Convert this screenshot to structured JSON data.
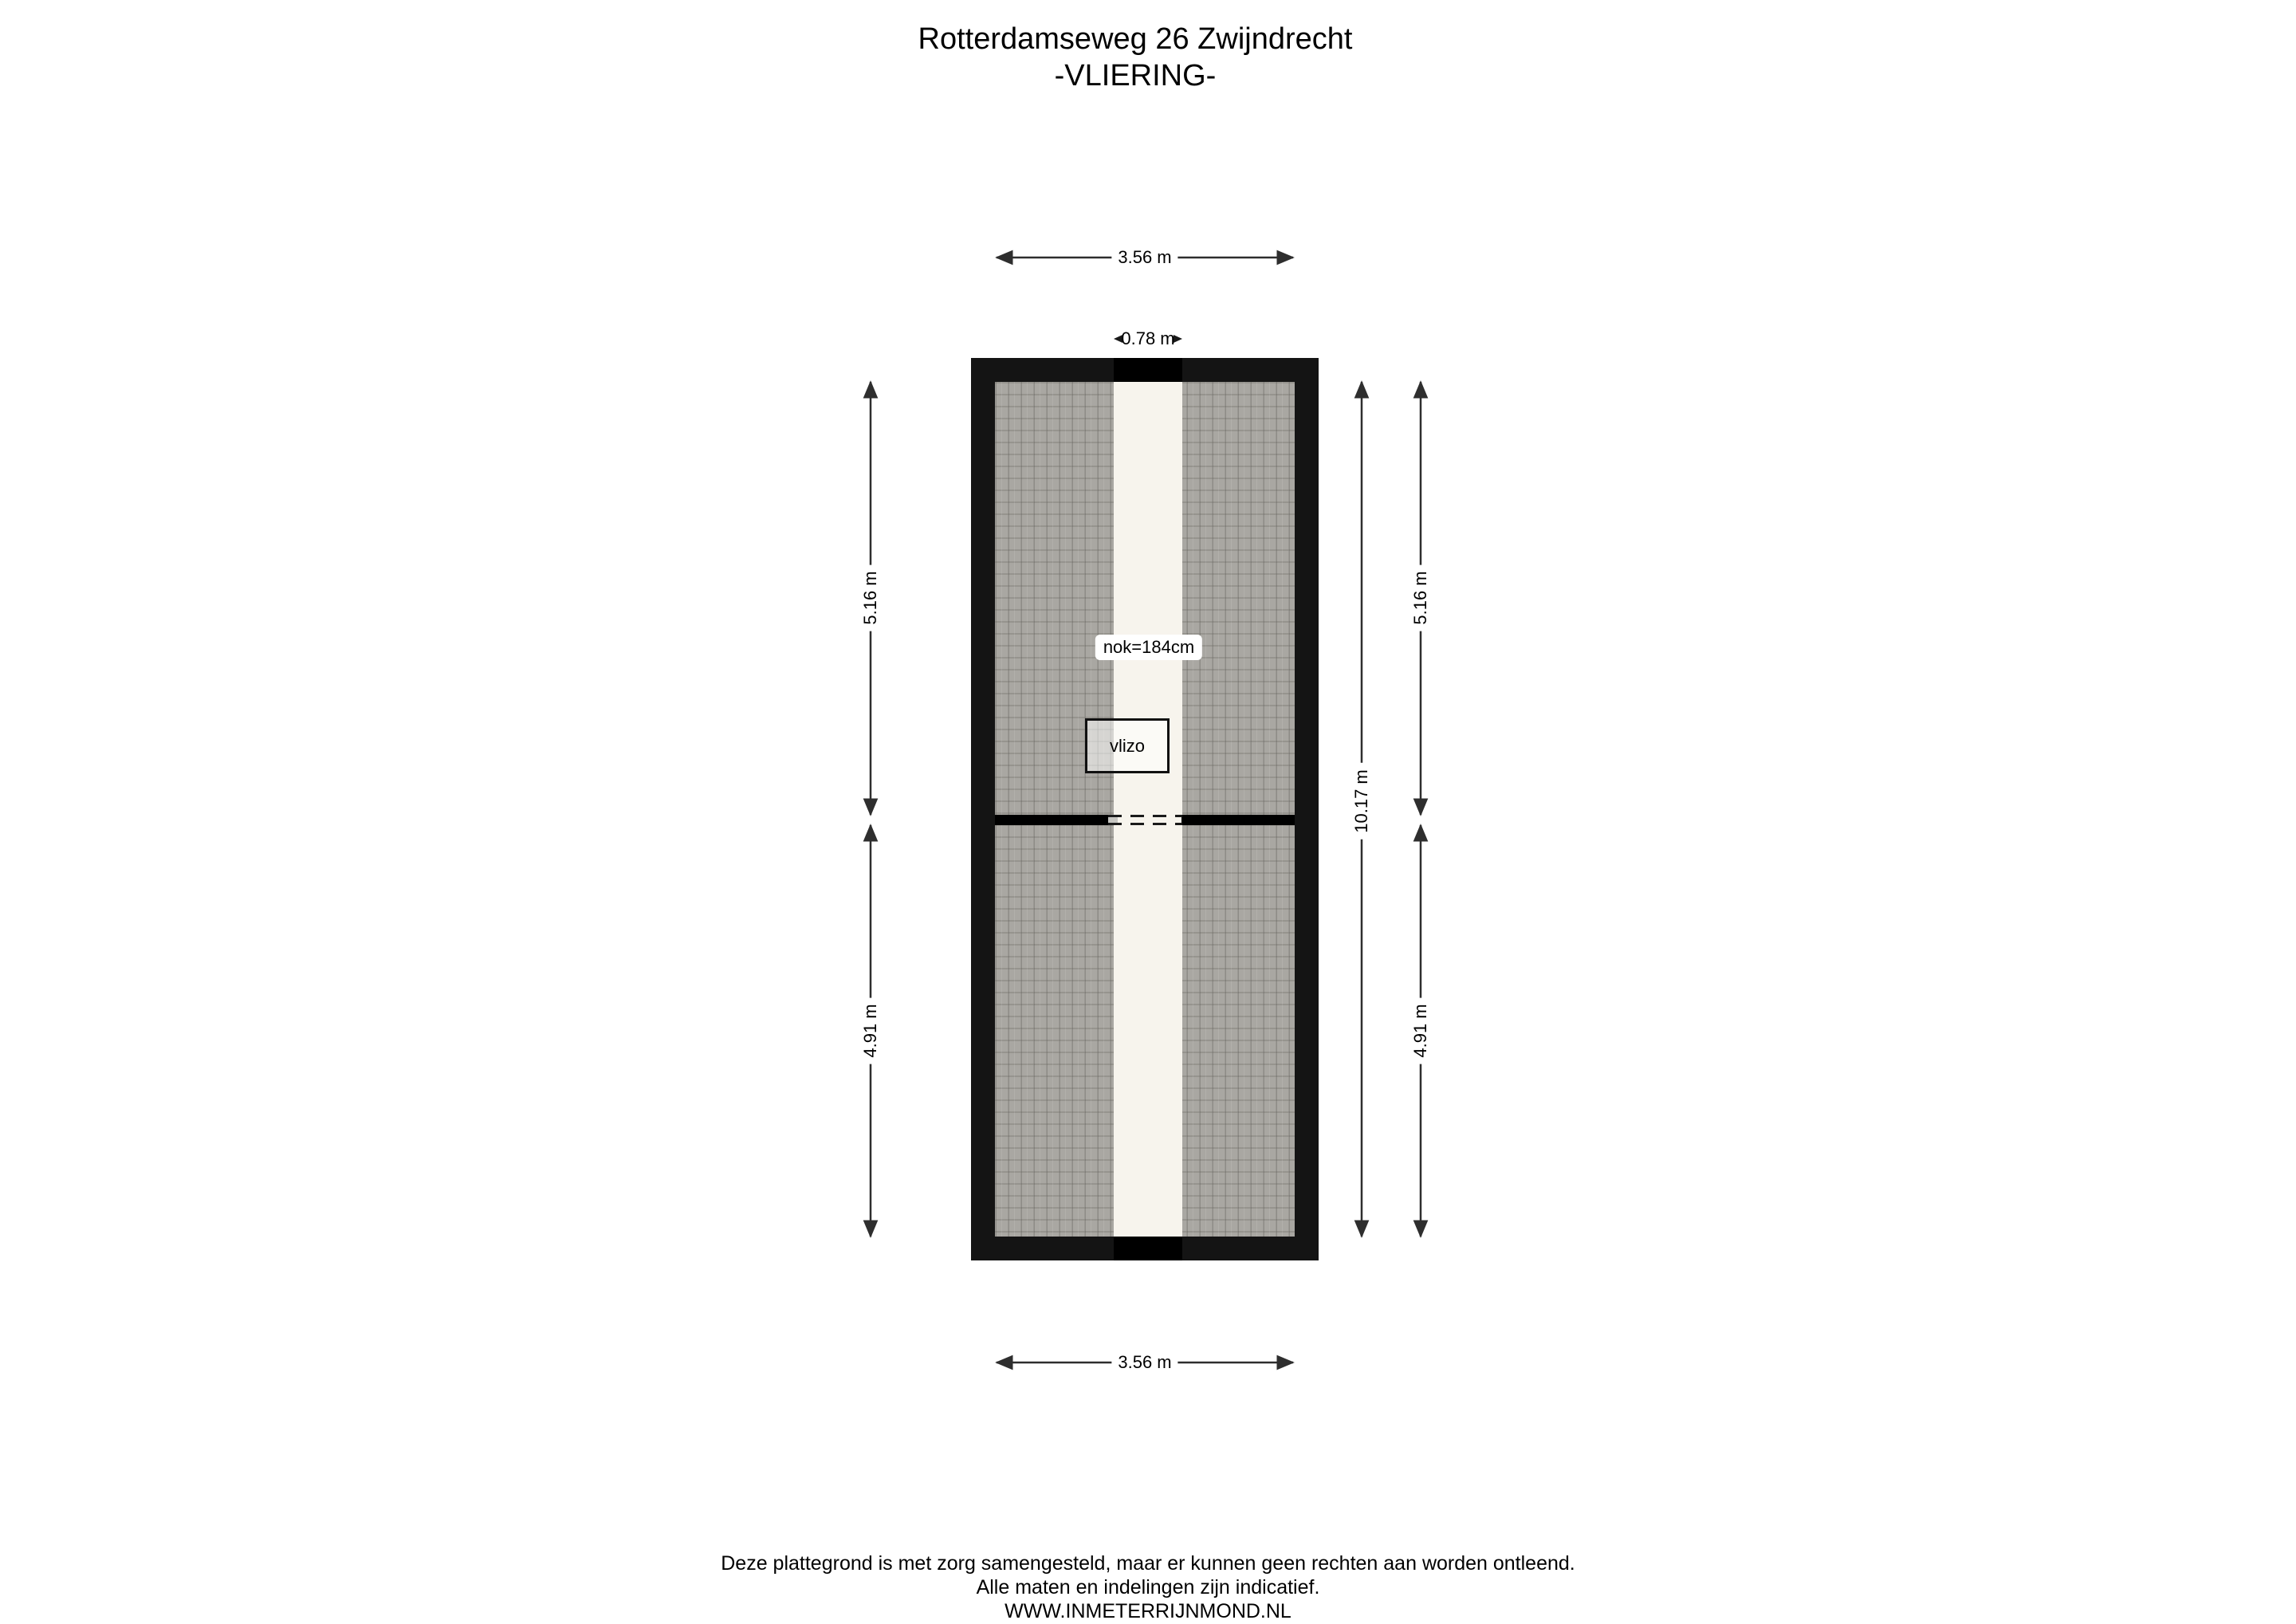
{
  "title": {
    "line1": "Rotterdamseweg 26 Zwijndrecht",
    "line2": "-VLIERING-"
  },
  "plan": {
    "room_label": "vlizo",
    "ridge_height_label": "nok=184cm",
    "dimensions": {
      "top_width": "3.56 m",
      "ridge_strip_width": "0.78 m",
      "bottom_width": "3.56 m",
      "left_upper_depth": "5.16 m",
      "left_lower_depth": "4.91 m",
      "right_total_depth": "10.17 m",
      "right_upper_depth": "5.16 m",
      "right_lower_depth": "4.91 m"
    }
  },
  "footer": {
    "line1": "Deze plattegrond is met zorg samengesteld, maar er kunnen geen rechten aan worden ontleend.",
    "line2": "Alle maten en indelingen zijn indicatief.",
    "line3": "WWW.INMETERRIJNMOND.NL"
  },
  "colors": {
    "background": "#ffffff",
    "wall": "#141414",
    "wall-ridge": "#000000",
    "hatch-base": "#a9a7a2",
    "strip": "#f7f4ed",
    "divider-cap": "#c6c5c1",
    "dim": "#2e2e2e",
    "text": "#000000"
  }
}
